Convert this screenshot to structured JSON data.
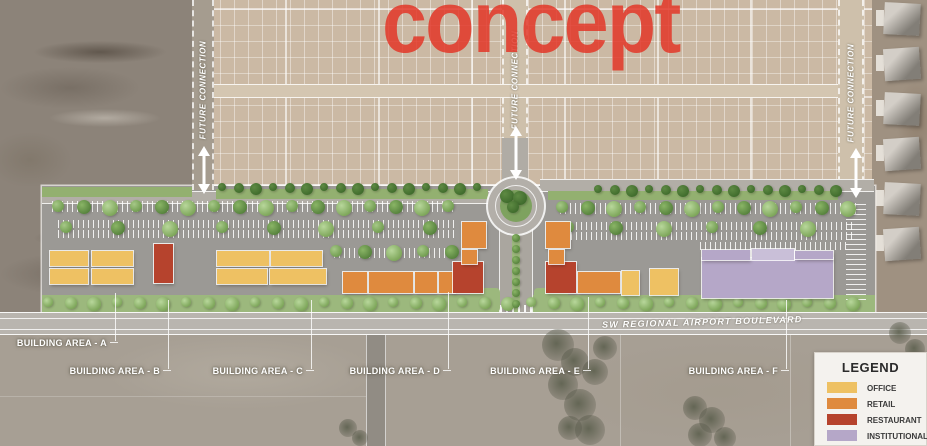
{
  "watermark": {
    "text": "concept",
    "color": "#e23426"
  },
  "site": {
    "street_label": "SW REGIONAL AIRPORT BOULEVARD",
    "future_connection_label": "FUTURE CONNECTION",
    "building_area_labels": [
      "BUILDING AREA - A",
      "BUILDING AREA - B",
      "BUILDING AREA - C",
      "BUILDING AREA - D",
      "BUILDING AREA - E",
      "BUILDING AREA - F"
    ]
  },
  "legend": {
    "title": "LEGEND",
    "items": [
      {
        "label": "OFFICE",
        "color": "#eec163"
      },
      {
        "label": "RETAIL",
        "color": "#df8a3e"
      },
      {
        "label": "RESTAURANT",
        "color": "#b6432d"
      },
      {
        "label": "INSTITUTIONAL",
        "color": "#b5a7c8"
      }
    ]
  }
}
